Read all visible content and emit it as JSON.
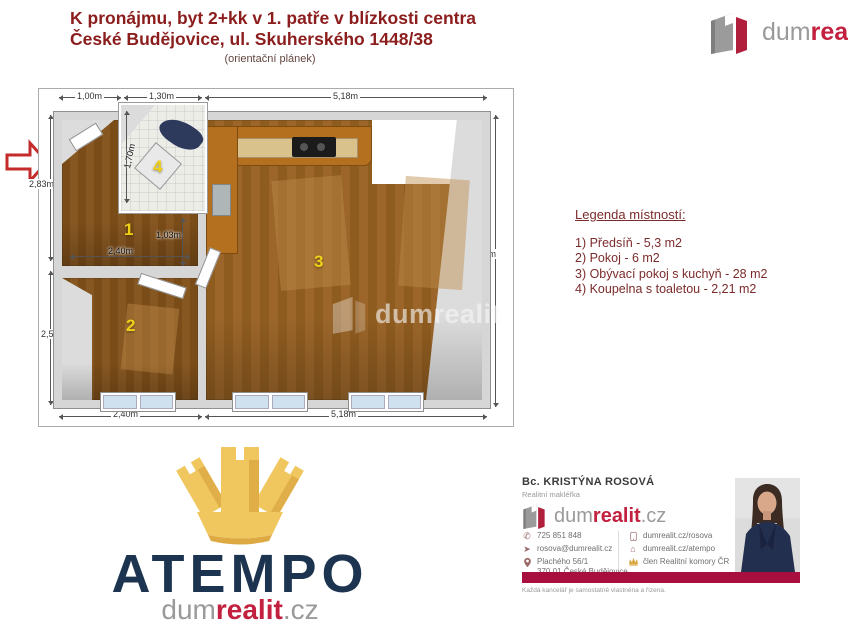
{
  "header": {
    "title_line1": "K pronájmu, byt 2+kk v 1. patře v blízkosti centra",
    "title_line2": "České Budějovice, ul. Skuherského 1448/38",
    "subtitle": "(orientační plánek)"
  },
  "brand": {
    "dum": "dum",
    "realit": "realit",
    "tld": ".cz",
    "watermark": "dumrealit",
    "red": "#C2203E",
    "gray": "#9A9A9A"
  },
  "floorplan": {
    "dims": {
      "top_left": "1,00m",
      "top_mid": "1,30m",
      "top_right": "5,18m",
      "left_upper": "2,83m",
      "left_lower": "2,50m",
      "right_side": "5,43m",
      "bottom_left": "2,40m",
      "bottom_right": "5,18m",
      "hall_width": "2,40m",
      "hall_depth": "1,03m",
      "bath_depth": "1,70m"
    },
    "rooms": {
      "hall": "1",
      "bedroom": "2",
      "living": "3",
      "bath": "4"
    }
  },
  "legend": {
    "title": "Legenda místností:",
    "items": [
      "1) Předsíň - 5,3 m2",
      "2) Pokoj - 6 m2",
      "3) Obývací pokoj s kuchyň - 28 m2",
      "4) Koupelna s toaletou - 2,21 m2"
    ]
  },
  "atempo": {
    "name": "ATEMPO"
  },
  "agent": {
    "name": "Bc. KRISTÝNA ROSOVÁ",
    "role": "Realitní makléřka",
    "phone": "725 851 848",
    "email": "rosova@dumrealit.cz",
    "address_line1": "Plachého 56/1",
    "address_line2": "370 01 České Budějovice",
    "web_profile": "dumrealit.cz/rosova",
    "web_office": "dumrealit.cz/atempo",
    "membership": "člen Realitní komory ČR",
    "disclaimer": "Každá kancelář je samostatně vlastněna a řízena.",
    "bar_color": "#A80F3F"
  }
}
